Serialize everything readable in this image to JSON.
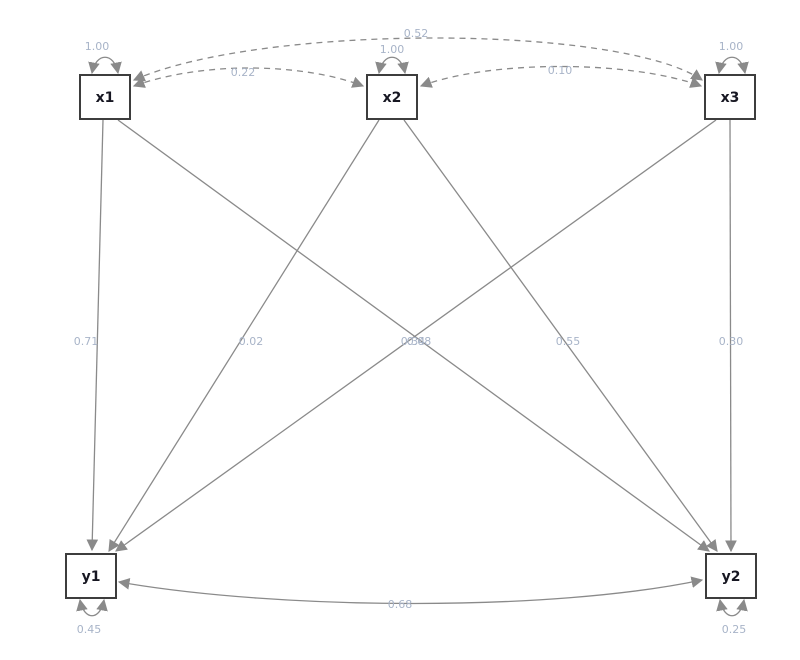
{
  "diagram": {
    "type": "sem-path-diagram",
    "canvas": {
      "width": 800,
      "height": 660,
      "background": "#ffffff"
    },
    "colors": {
      "edge": "#8a8a8a",
      "edge_label": "#a8b4c8",
      "node_border": "#3d3d3d",
      "node_fill": "#ffffff",
      "node_label": "#171722"
    },
    "nodes": [
      {
        "id": "x1",
        "label": "x1",
        "shape": "square",
        "row": "top"
      },
      {
        "id": "x2",
        "label": "x2",
        "shape": "square",
        "row": "top"
      },
      {
        "id": "x3",
        "label": "x3",
        "shape": "square",
        "row": "top"
      },
      {
        "id": "y1",
        "label": "y1",
        "shape": "square",
        "row": "bottom"
      },
      {
        "id": "y2",
        "label": "y2",
        "shape": "square",
        "row": "bottom"
      }
    ],
    "edges": [
      {
        "from": "x1",
        "to": "y1",
        "label": "0.71",
        "style": "solid",
        "arrows": "single"
      },
      {
        "from": "x2",
        "to": "y1",
        "label": "0.02",
        "style": "solid",
        "arrows": "single"
      },
      {
        "from": "x3",
        "to": "y1",
        "label": "0.34",
        "style": "solid",
        "arrows": "single"
      },
      {
        "from": "x1",
        "to": "y2",
        "label": "0.08",
        "style": "solid",
        "arrows": "single"
      },
      {
        "from": "x2",
        "to": "y2",
        "label": "0.55",
        "style": "solid",
        "arrows": "single"
      },
      {
        "from": "x3",
        "to": "y2",
        "label": "0.30",
        "style": "solid",
        "arrows": "single"
      },
      {
        "from": "x1",
        "to": "x2",
        "label": "0.22",
        "style": "dashed",
        "arrows": "double"
      },
      {
        "from": "x2",
        "to": "x3",
        "label": "0.10",
        "style": "dashed",
        "arrows": "double"
      },
      {
        "from": "x1",
        "to": "x3",
        "label": "0.52",
        "style": "dashed",
        "arrows": "double"
      },
      {
        "from": "y1",
        "to": "y2",
        "label": "0.68",
        "style": "solid",
        "arrows": "double"
      }
    ],
    "variances": [
      {
        "node": "x1",
        "label": "1.00",
        "position": "top"
      },
      {
        "node": "x2",
        "label": "1.00",
        "position": "top"
      },
      {
        "node": "x3",
        "label": "1.00",
        "position": "top"
      },
      {
        "node": "y1",
        "label": "0.45",
        "position": "bottom"
      },
      {
        "node": "y2",
        "label": "0.25",
        "position": "bottom"
      }
    ]
  }
}
